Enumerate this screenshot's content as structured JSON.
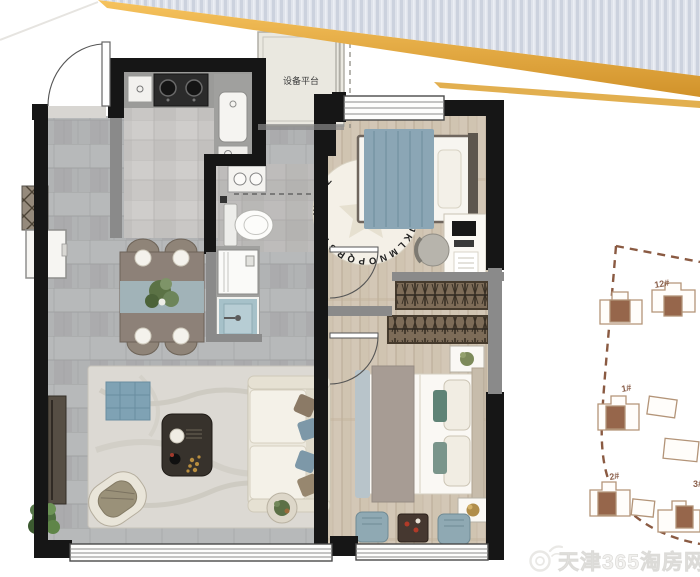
{
  "banner": {
    "silver_color": "#ccd2de",
    "gold_color": "#e2a53b"
  },
  "floor_plan": {
    "equipment_platform_label": "设备平台",
    "alphabet_rug_letters": "ABCDEFGHIJKLMNOPQRSTUVWXYZ"
  },
  "site_plan": {
    "building_labels": [
      "12#",
      "1#",
      "2#",
      "3#"
    ]
  },
  "watermark": {
    "text": "天津365淘房网",
    "icon": "weibo-icon",
    "color": "#f2f1ef"
  }
}
